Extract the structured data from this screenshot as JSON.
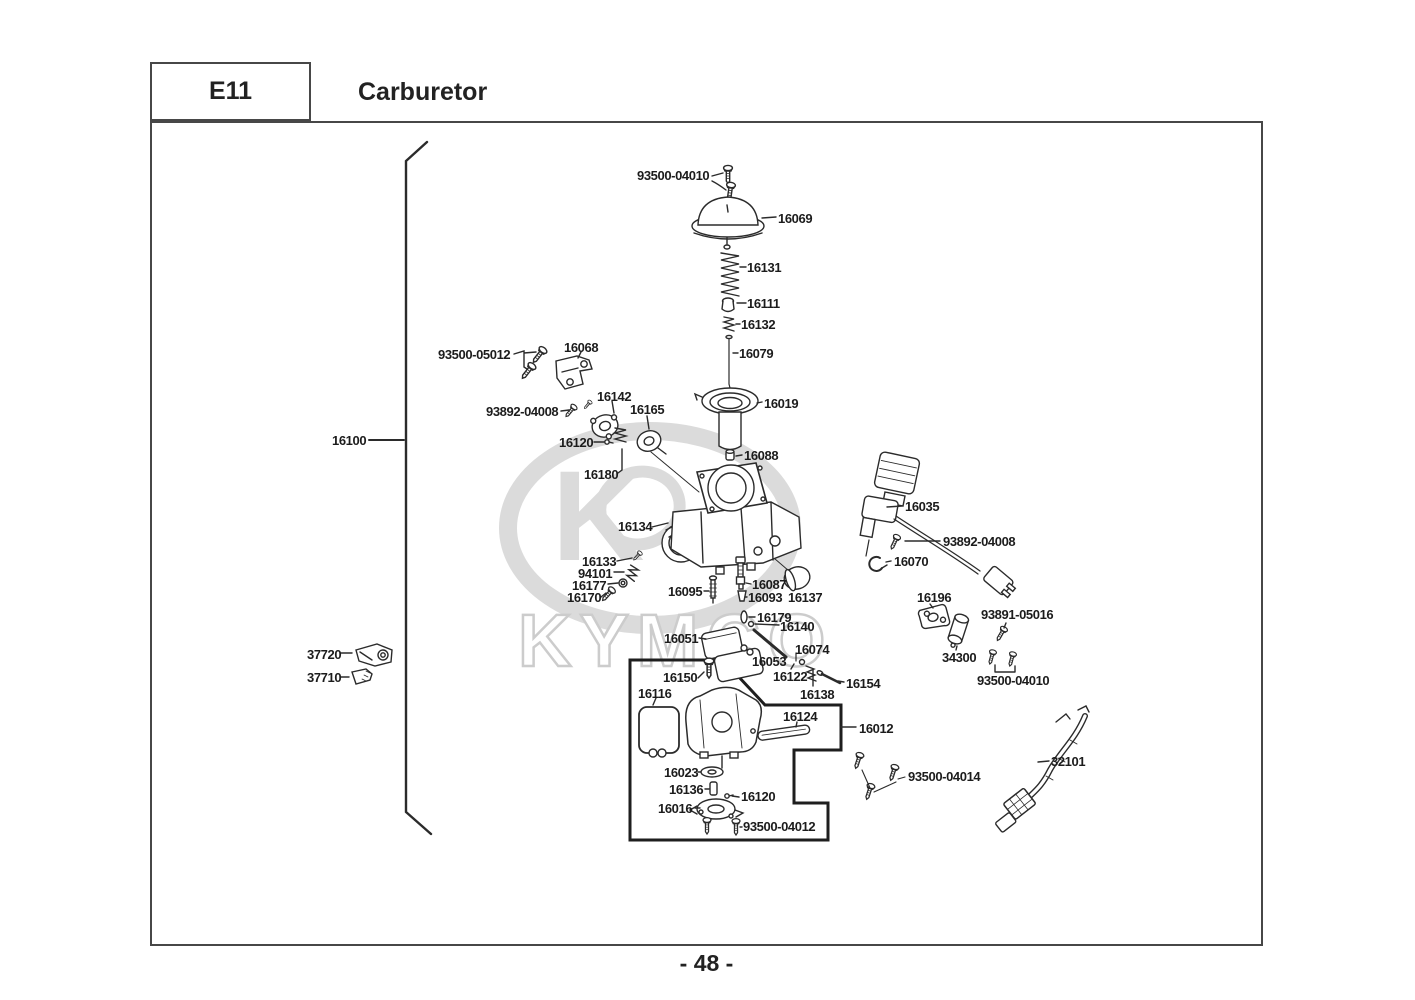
{
  "page": {
    "code": "E11",
    "title": "Carburetor",
    "page_number": "- 48 -",
    "brand_watermark": "KYMCO"
  },
  "colors": {
    "line": "#2b2b2b",
    "border": "#474747",
    "watermark": "#dbdbdb"
  },
  "labels": [
    {
      "text": "93500-04010",
      "x": 637,
      "y": 168
    },
    {
      "text": "16069",
      "x": 778,
      "y": 211
    },
    {
      "text": "16131",
      "x": 747,
      "y": 260
    },
    {
      "text": "16111",
      "x": 747,
      "y": 296
    },
    {
      "text": "16132",
      "x": 741,
      "y": 317
    },
    {
      "text": "16079",
      "x": 739,
      "y": 346
    },
    {
      "text": "16019",
      "x": 764,
      "y": 396
    },
    {
      "text": "93500-05012",
      "x": 438,
      "y": 347
    },
    {
      "text": "16068",
      "x": 564,
      "y": 340
    },
    {
      "text": "16142",
      "x": 597,
      "y": 389
    },
    {
      "text": "93892-04008",
      "x": 486,
      "y": 404
    },
    {
      "text": "16165",
      "x": 630,
      "y": 402
    },
    {
      "text": "16120",
      "x": 559,
      "y": 435
    },
    {
      "text": "16180",
      "x": 584,
      "y": 467
    },
    {
      "text": "16100",
      "x": 332,
      "y": 433
    },
    {
      "text": "16088",
      "x": 744,
      "y": 448
    },
    {
      "text": "16035",
      "x": 905,
      "y": 499
    },
    {
      "text": "93892-04008",
      "x": 943,
      "y": 534
    },
    {
      "text": "16070",
      "x": 894,
      "y": 554
    },
    {
      "text": "16134",
      "x": 618,
      "y": 519
    },
    {
      "text": "16133",
      "x": 582,
      "y": 554
    },
    {
      "text": "94101",
      "x": 578,
      "y": 566
    },
    {
      "text": "16177",
      "x": 572,
      "y": 578
    },
    {
      "text": "16170",
      "x": 567,
      "y": 590
    },
    {
      "text": "16095",
      "x": 668,
      "y": 584
    },
    {
      "text": "16087",
      "x": 752,
      "y": 577
    },
    {
      "text": "16093",
      "x": 748,
      "y": 590
    },
    {
      "text": "16137",
      "x": 788,
      "y": 590
    },
    {
      "text": "16196",
      "x": 917,
      "y": 590
    },
    {
      "text": "93891-05016",
      "x": 981,
      "y": 607
    },
    {
      "text": "34300",
      "x": 942,
      "y": 650
    },
    {
      "text": "93500-04010",
      "x": 977,
      "y": 673
    },
    {
      "text": "16179",
      "x": 757,
      "y": 610
    },
    {
      "text": "16140",
      "x": 780,
      "y": 619
    },
    {
      "text": "16051",
      "x": 664,
      "y": 631
    },
    {
      "text": "16074",
      "x": 795,
      "y": 642
    },
    {
      "text": "16053",
      "x": 752,
      "y": 654
    },
    {
      "text": "16122",
      "x": 773,
      "y": 669
    },
    {
      "text": "16154",
      "x": 846,
      "y": 676
    },
    {
      "text": "16138",
      "x": 800,
      "y": 687
    },
    {
      "text": "16150",
      "x": 663,
      "y": 670
    },
    {
      "text": "16116",
      "x": 638,
      "y": 686
    },
    {
      "text": "16124",
      "x": 783,
      "y": 709
    },
    {
      "text": "16012",
      "x": 859,
      "y": 721
    },
    {
      "text": "37720",
      "x": 307,
      "y": 647
    },
    {
      "text": "37710",
      "x": 307,
      "y": 670
    },
    {
      "text": "16023",
      "x": 664,
      "y": 765
    },
    {
      "text": "16136",
      "x": 669,
      "y": 782
    },
    {
      "text": "16120",
      "x": 741,
      "y": 789
    },
    {
      "text": "16016",
      "x": 658,
      "y": 801
    },
    {
      "text": "93500-04012",
      "x": 743,
      "y": 819
    },
    {
      "text": "93500-04014",
      "x": 908,
      "y": 769
    },
    {
      "text": "32101",
      "x": 1051,
      "y": 754
    }
  ]
}
